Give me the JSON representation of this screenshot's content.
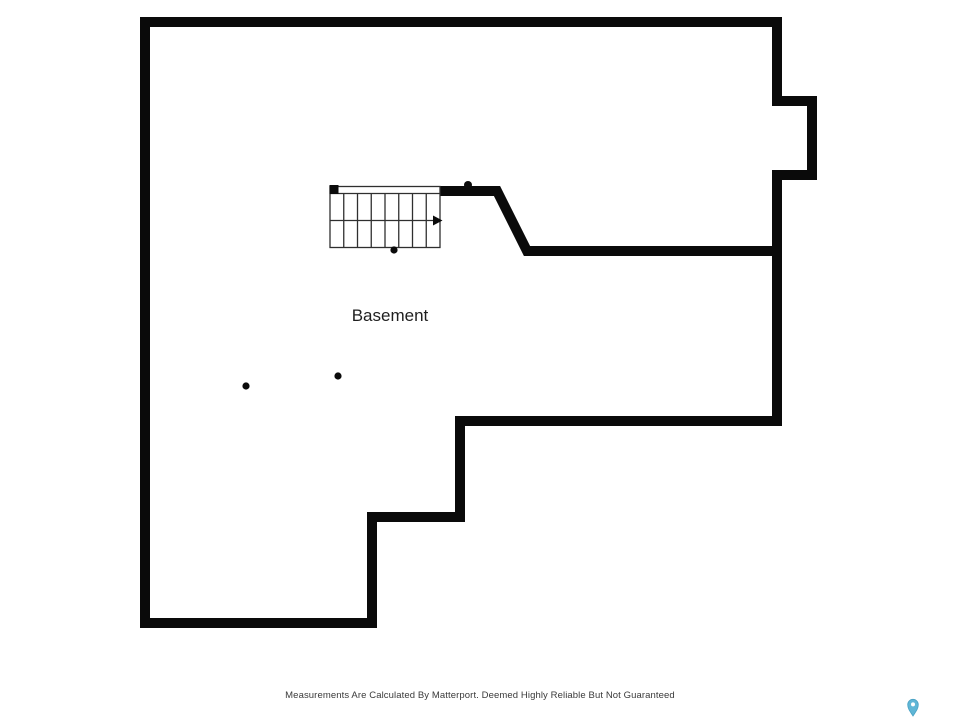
{
  "floor_plan": {
    "room_label": "Basement"
  },
  "stairs": {
    "tread_count": 8,
    "direction_arrow": "right"
  },
  "point_markers": {
    "count": 4
  },
  "footer": {
    "disclaimer": "Measurements Are Calculated By Matterport. Deemed Highly Reliable But Not Guaranteed"
  },
  "branding": {
    "pin_color": "#5fb6d6",
    "pin_stroke": "#49a2c4"
  },
  "colors": {
    "background": "#ffffff",
    "walls": "#0a0a0a",
    "stair_lines": "#2f2f2f",
    "room_label_text": "#1f1f1f",
    "disclaimer_text": "#3a3a3a"
  }
}
